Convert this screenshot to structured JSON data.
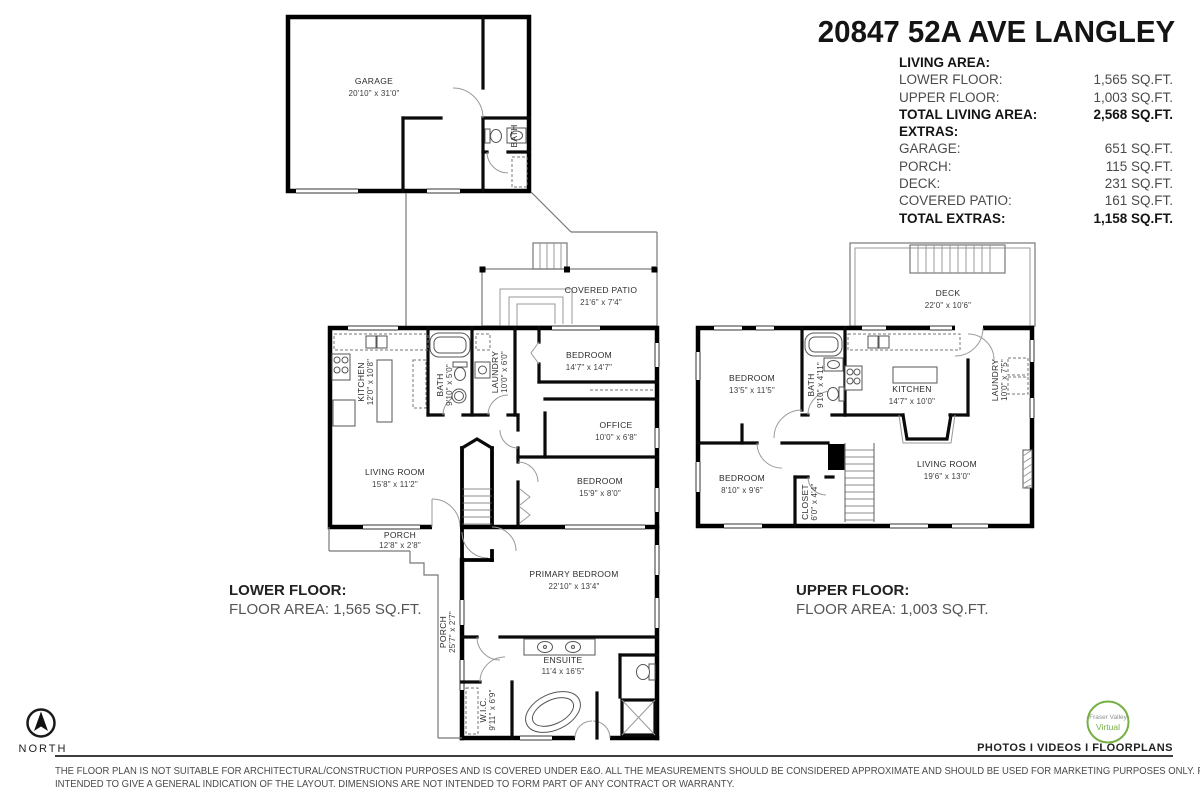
{
  "title": "20847 52A AVE LANGLEY",
  "summary": {
    "rows": [
      {
        "label": "LIVING AREA:",
        "value": ""
      },
      {
        "label": "LOWER FLOOR:",
        "value": "1,565 SQ.FT."
      },
      {
        "label": "UPPER FLOOR:",
        "value": "1,003 SQ.FT."
      },
      {
        "label": "TOTAL LIVING AREA:",
        "value": "2,568 SQ.FT."
      },
      {
        "label": "EXTRAS:",
        "value": ""
      },
      {
        "label": "GARAGE:",
        "value": "651 SQ.FT."
      },
      {
        "label": "PORCH:",
        "value": "115 SQ.FT."
      },
      {
        "label": "DECK:",
        "value": "231 SQ.FT."
      },
      {
        "label": "COVERED PATIO:",
        "value": "161 SQ.FT."
      },
      {
        "label": "TOTAL EXTRAS:",
        "value": "1,158 SQ.FT."
      }
    ]
  },
  "garage_plan": {
    "garage": {
      "name": "GARAGE",
      "dims": "20'10\" x 31'0\""
    },
    "bath": {
      "name": "BATH"
    }
  },
  "lower_floor": {
    "heading": "LOWER FLOOR:",
    "area": "FLOOR AREA: 1,565 SQ.FT.",
    "rooms": {
      "covered_patio": {
        "name": "COVERED PATIO",
        "dims": "21'6\" x 7'4\""
      },
      "kitchen": {
        "name": "KITCHEN",
        "dims": "12'0\" x 10'8\""
      },
      "bath": {
        "name": "BATH",
        "dims": "9'10\" x 5'0\""
      },
      "laundry": {
        "name": "LAUNDRY",
        "dims": "10'0\" x 6'0\""
      },
      "bedroom1": {
        "name": "BEDROOM",
        "dims": "14'7\" x 14'7\""
      },
      "office": {
        "name": "OFFICE",
        "dims": "10'0\" x 6'8\""
      },
      "living_room": {
        "name": "LIVING ROOM",
        "dims": "15'8\" x 11'2\""
      },
      "bedroom2": {
        "name": "BEDROOM",
        "dims": "15'9\" x 8'0\""
      },
      "porch_front": {
        "name": "PORCH",
        "dims": "12'8\" x 2'8\""
      },
      "primary_bedroom": {
        "name": "PRIMARY BEDROOM",
        "dims": "22'10\" x 13'4\""
      },
      "porch_side": {
        "name": "PORCH",
        "dims": "25'7\" x 2'7\""
      },
      "ensuite": {
        "name": "ENSUITE",
        "dims": "11'4 x 16'5\""
      },
      "wic": {
        "name": "W.I.C.",
        "dims": "9'11\" x 6'9\""
      }
    }
  },
  "upper_floor": {
    "heading": "UPPER FLOOR:",
    "area": "FLOOR AREA: 1,003 SQ.FT.",
    "rooms": {
      "deck": {
        "name": "DECK",
        "dims": "22'0\" x 10'6\""
      },
      "bedroom1": {
        "name": "BEDROOM",
        "dims": "13'5\" x 11'5\""
      },
      "bath": {
        "name": "BATH",
        "dims": "9'10\" x 4'11\""
      },
      "kitchen": {
        "name": "KITCHEN",
        "dims": "14'7\" x 10'0\""
      },
      "laundry": {
        "name": "LAUNDRY",
        "dims": "10'0\" x 7'5\""
      },
      "bedroom2": {
        "name": "BEDROOM",
        "dims": "8'10\" x 9'6\""
      },
      "closet": {
        "name": "CLOSET",
        "dims": "6'0\" x 4'4\""
      },
      "living_room": {
        "name": "LIVING ROOM",
        "dims": "19'6\" x 13'0\""
      }
    }
  },
  "compass": {
    "label": "NORTH"
  },
  "branding": {
    "logo_top": "Fraser Valley",
    "logo_bottom": "Virtual",
    "tagline": "PHOTOS I VIDEOS I FLOORPLANS",
    "accent": "#76b043"
  },
  "disclaimer": {
    "line1": "THE FLOOR PLAN IS NOT SUITABLE FOR ARCHITECTURAL/CONSTRUCTION PURPOSES AND IS COVERED UNDER E&O. ALL THE MEASUREMENTS SHOULD BE CONSIDERED APPROXIMATE AND SHOULD BE USED FOR MARKETING PURPOSES ONLY. FLOOR PLAN(S) IS",
    "line2": "INTENDED TO GIVE A GENERAL INDICATION OF THE LAYOUT. DIMENSIONS ARE NOT INTENDED TO FORM PART OF ANY CONTRACT OR WARRANTY."
  }
}
